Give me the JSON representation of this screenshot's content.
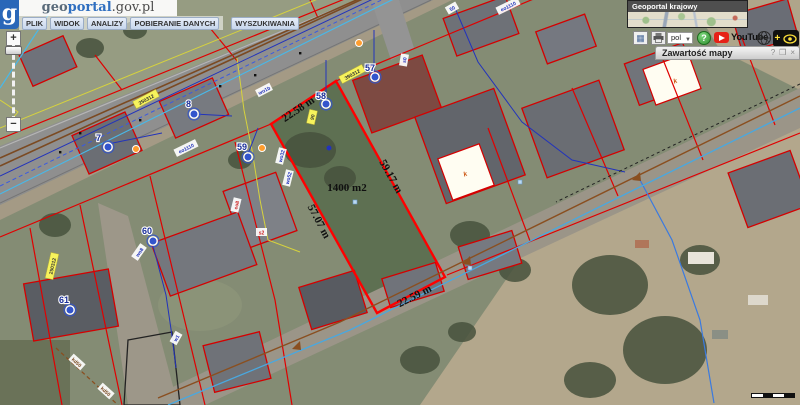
{
  "header": {
    "logo": "g",
    "brand": {
      "geo": "geo",
      "portal": "portal",
      "suffix": ".gov.pl"
    },
    "menu": [
      {
        "label": "PLIK"
      },
      {
        "label": "WIDOK"
      },
      {
        "label": "ANALIZY"
      },
      {
        "label": "POBIERANIE DANYCH"
      },
      {
        "label": "WYSZUKIWANIA"
      }
    ]
  },
  "zoom_control": {
    "zoom_in": "+",
    "zoom_out": "−"
  },
  "overview": {
    "title": "Geoportal krajowy"
  },
  "toolbar": {
    "language_value": "pol",
    "youtube_label": "YouTube",
    "help_label": "?",
    "plus_label": "+"
  },
  "layers_panel": {
    "title": "Zawartość mapy",
    "help": "?",
    "maximize": "❒",
    "close": "×"
  },
  "map": {
    "area_label": "1400 m2",
    "measurements": [
      {
        "label": "22.58 m"
      },
      {
        "label": "59.17 m"
      },
      {
        "label": "57.07 m"
      },
      {
        "label": "22.59 m"
      }
    ],
    "points": [
      {
        "label": "7"
      },
      {
        "label": "8"
      },
      {
        "label": "57"
      },
      {
        "label": "58"
      },
      {
        "label": "59"
      },
      {
        "label": "60"
      },
      {
        "label": "61"
      }
    ],
    "road_labels": [
      {
        "text": "390312"
      },
      {
        "text": "250312"
      },
      {
        "text": "250312"
      },
      {
        "text": "90"
      }
    ],
    "utility_labels": [
      {
        "text": "eo1110"
      },
      {
        "text": "eo1110"
      },
      {
        "text": "wo1b"
      },
      {
        "text": "s0"
      },
      {
        "text": "wo32"
      },
      {
        "text": "wo52"
      },
      {
        "text": "eo8"
      },
      {
        "text": "wo8"
      },
      {
        "text": "kd50"
      },
      {
        "text": "kd50"
      },
      {
        "text": "s2"
      },
      {
        "text": "w1"
      },
      {
        "text": "50"
      }
    ],
    "parcel_marks": [
      {
        "text": "k"
      },
      {
        "text": "k"
      }
    ],
    "colors": {
      "parcel_line": "#e00000",
      "measured_parcel_line": "#ff0000",
      "point_marker": "#3355cc",
      "road_label_bg": "#f7f35c",
      "water_line": "#2233bb",
      "gas_line": "#d6d23e",
      "power_line": "#7b4a22"
    }
  }
}
